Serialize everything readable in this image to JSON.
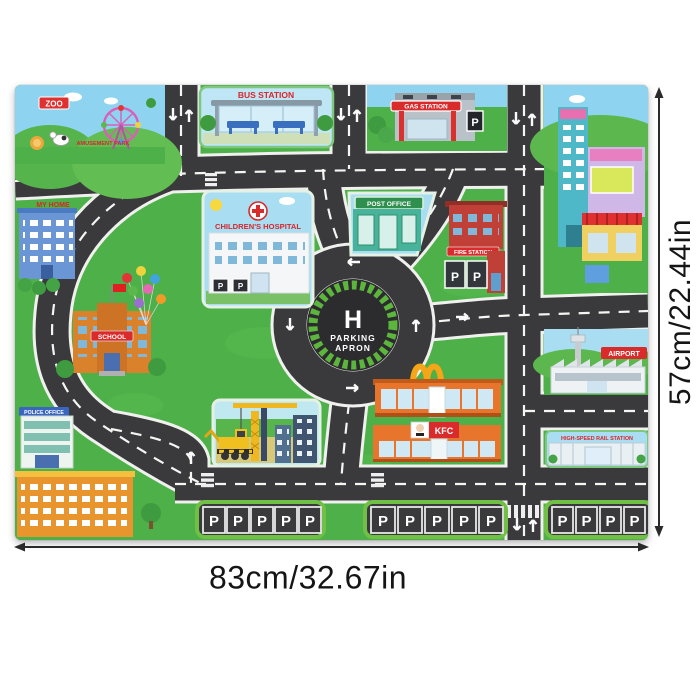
{
  "dimensions": {
    "height_label": "57cm/22.44in",
    "width_label": "83cm/32.67in"
  },
  "mat": {
    "labels": {
      "zoo": "ZOO",
      "amusement_park": "AMUSEMENT PARK",
      "bus_station": "BUS STATION",
      "gas_station": "GAS STATION",
      "my_home": "MY HOME",
      "childrens_hospital": "CHILDREN'S HOSPITAL",
      "post_office": "POST OFFICE",
      "fire_station": "FIRE STATION",
      "school": "SCHOOL",
      "police_office": "POLICE OFFICE",
      "airport": "AIRPORT",
      "kfc": "KFC",
      "high_speed_rail": "HIGH-SPEED RAIL STATION",
      "helipad_letter": "H",
      "helipad_sub1": "PARKING",
      "helipad_sub2": "APRON",
      "parking_p": "P"
    },
    "colors": {
      "grass": "#4db049",
      "road": "#3a3a3c",
      "sky": "#a8ddf2",
      "sign_red": "#d7262c",
      "parking_frame_green": "#6fc045"
    },
    "parking_rows": [
      5,
      5,
      4
    ]
  }
}
